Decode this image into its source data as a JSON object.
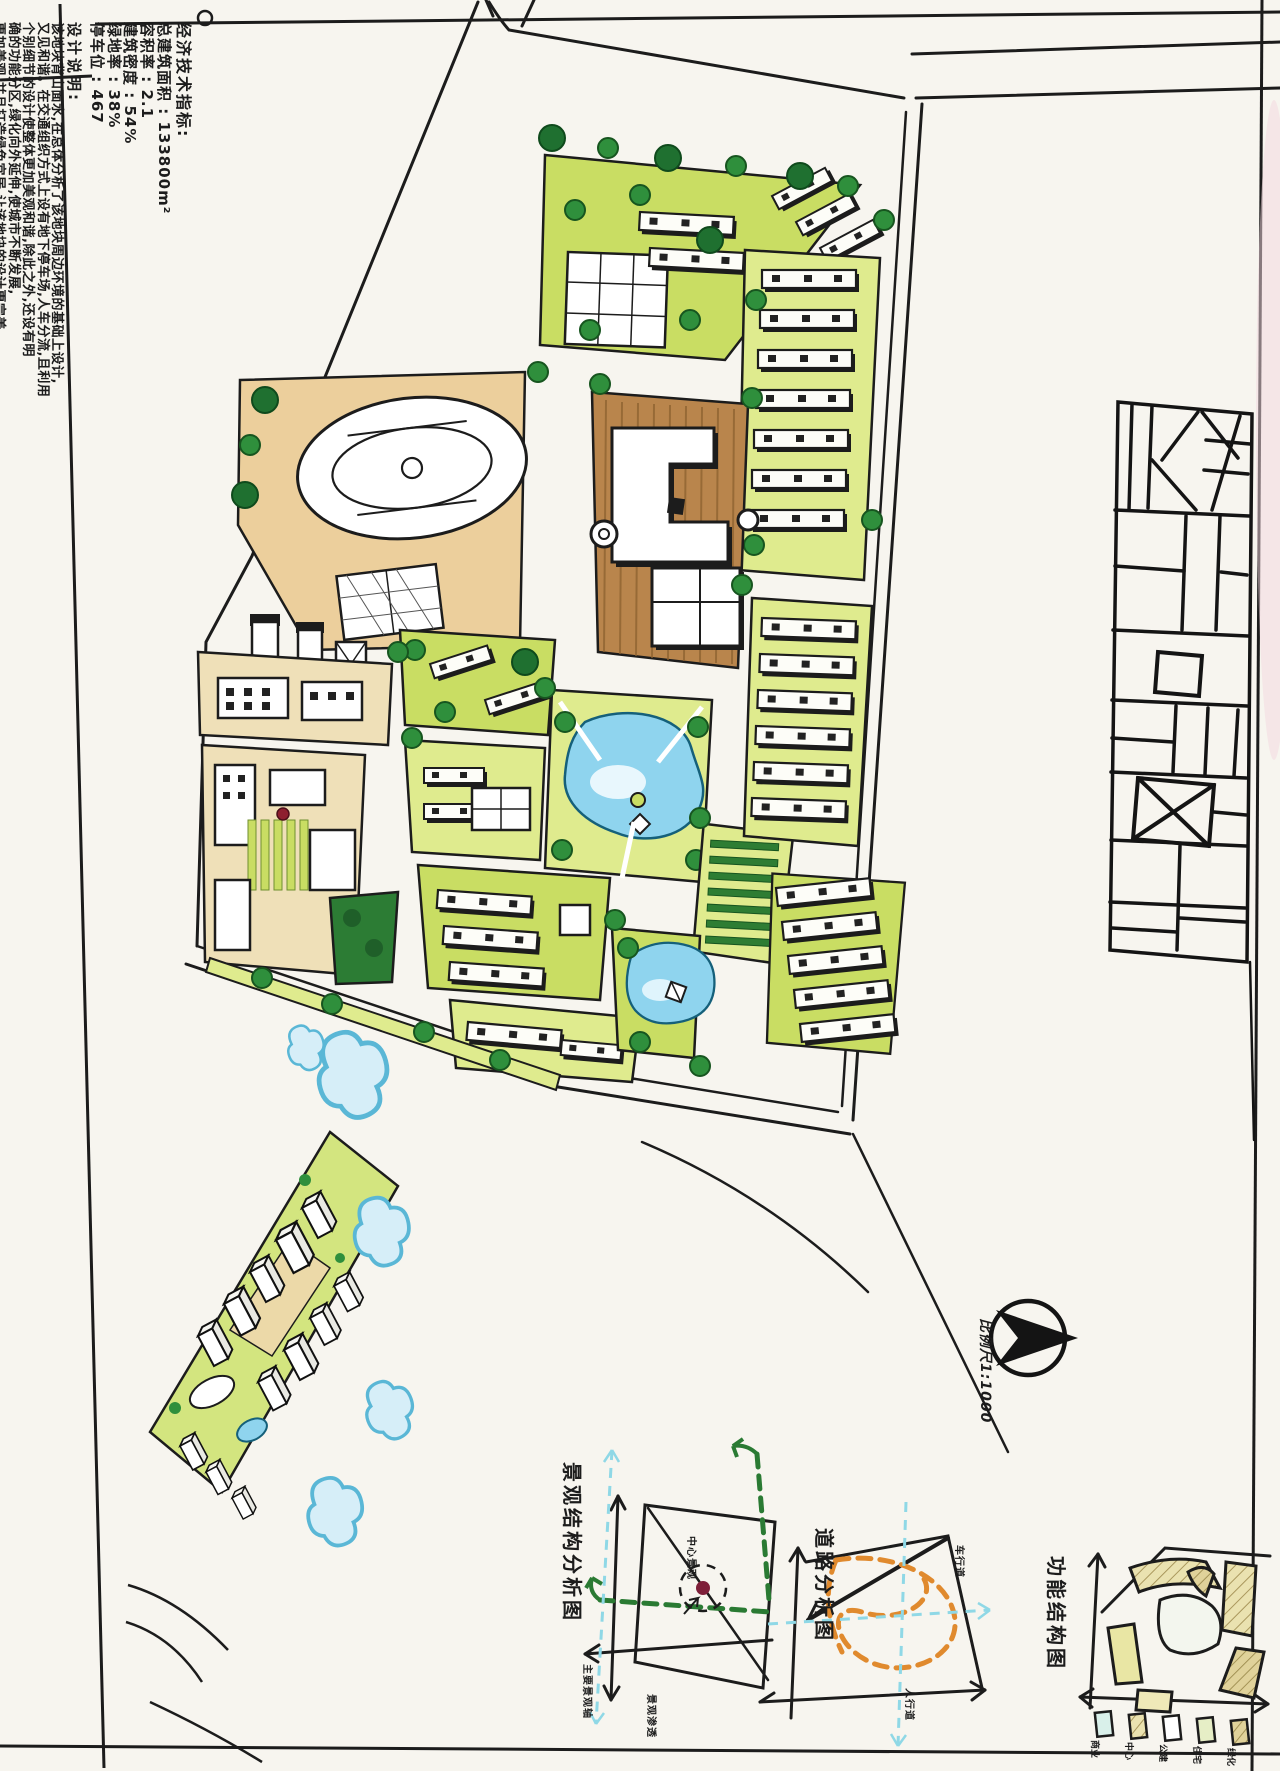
{
  "sheet": {
    "indicators": {
      "title": "经济技术指标:",
      "items": [
        "总建筑面积 : 133800m²",
        "容积率   : 2.1",
        "建筑密度  : 54%",
        "绿地率   : 38%",
        "停车位   : 467"
      ]
    },
    "description": {
      "title": "设计说明:",
      "lines": [
        "该地块背山面水,在总体分析了该地块周边环境的基础上设计,",
        "又见和谐。在交通组织方式上设有地下停车场,人车分流,且利用",
        "个别细节的设计使整体更加美观和谐,除此之外,还设有明",
        "确的功能分区,绿化向外延伸,使城市不断发展,",
        "更加美观,并且打造绿色宜居,让该地块的设计更完美。"
      ]
    },
    "compass": {
      "scale_label": "比例尺1:1000"
    },
    "diagrams": {
      "landscape": {
        "title": "景观结构分析图",
        "center_label": "中心景观",
        "axis_label": "主要景观轴",
        "bottom_label": "景观渗透"
      },
      "traffic": {
        "title": "道路分析图",
        "vehicle_label": "车行道",
        "pedestrian_label": "人行道"
      },
      "function": {
        "title": "功能结构图",
        "legend": [
          "商业",
          "中心",
          "公建",
          "住宅",
          "绿化"
        ]
      }
    },
    "colors": {
      "paper": "#f7f5ef",
      "ink": "#1c1c1c",
      "lawn": "#c9dd63",
      "lawn_light": "#dfeb8e",
      "tree": "#2f8f3c",
      "tree_dark": "#1f7030",
      "water": "#8fd4ee",
      "tan": "#eccf9c",
      "plaza": "#b9854c",
      "orange_route": "#e08a2e",
      "cyan_route": "#8fd8e6",
      "accent_red": "#7e1f39",
      "khaki": "#eae2b0"
    }
  }
}
